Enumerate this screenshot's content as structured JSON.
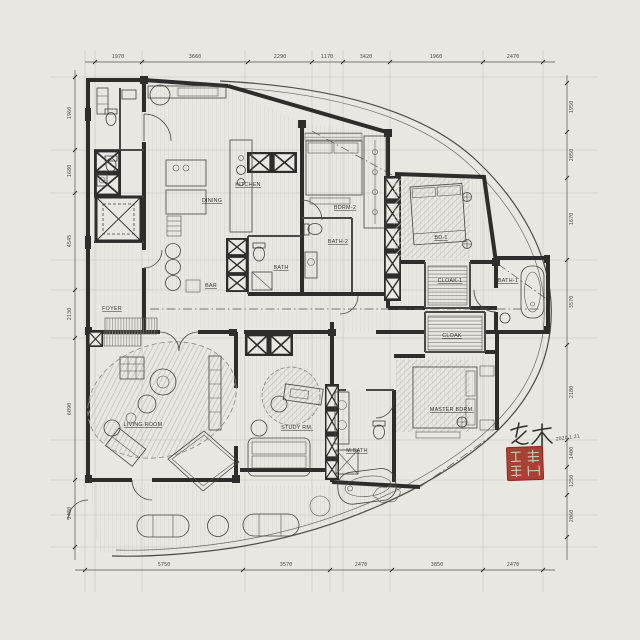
{
  "palette": {
    "paper": "#e9e7e2",
    "ink": "#2e2d29",
    "line": "#55524d",
    "faint_grid": "#c6c4bc",
    "seal_red": "#a23428"
  },
  "plan": {
    "rooms": {
      "foyer": "FOYER",
      "dining": "DINING",
      "kitchen": "KITCHEN",
      "bar": "BAR",
      "bath": "BATH",
      "bdrm2": "BDRM-2",
      "bath2": "BATH-2",
      "bd1": "BD-1",
      "cloak1": "CLOAK-1",
      "bath1": "BATH-1",
      "cloak": "CLOAK",
      "living": "LIVING ROOM",
      "study": "STUDY RM.",
      "master": "MASTER BDRM.",
      "mbath": "M.BATH"
    }
  },
  "dimensions": {
    "top": [
      "1970",
      "3660",
      "2290",
      "1170",
      "3420",
      "1960",
      "2470"
    ],
    "bottom": [
      "5750",
      "3570",
      "2470",
      "3850",
      "2470"
    ],
    "left": [
      "1960",
      "1680",
      "4545",
      "2130",
      "6090",
      "2480"
    ],
    "right": [
      "1950",
      "2050",
      "1670",
      "3570",
      "2180",
      "1400",
      "1250",
      "2060"
    ]
  },
  "annotation": {
    "signature": "老木",
    "date": "2020.1.21"
  }
}
